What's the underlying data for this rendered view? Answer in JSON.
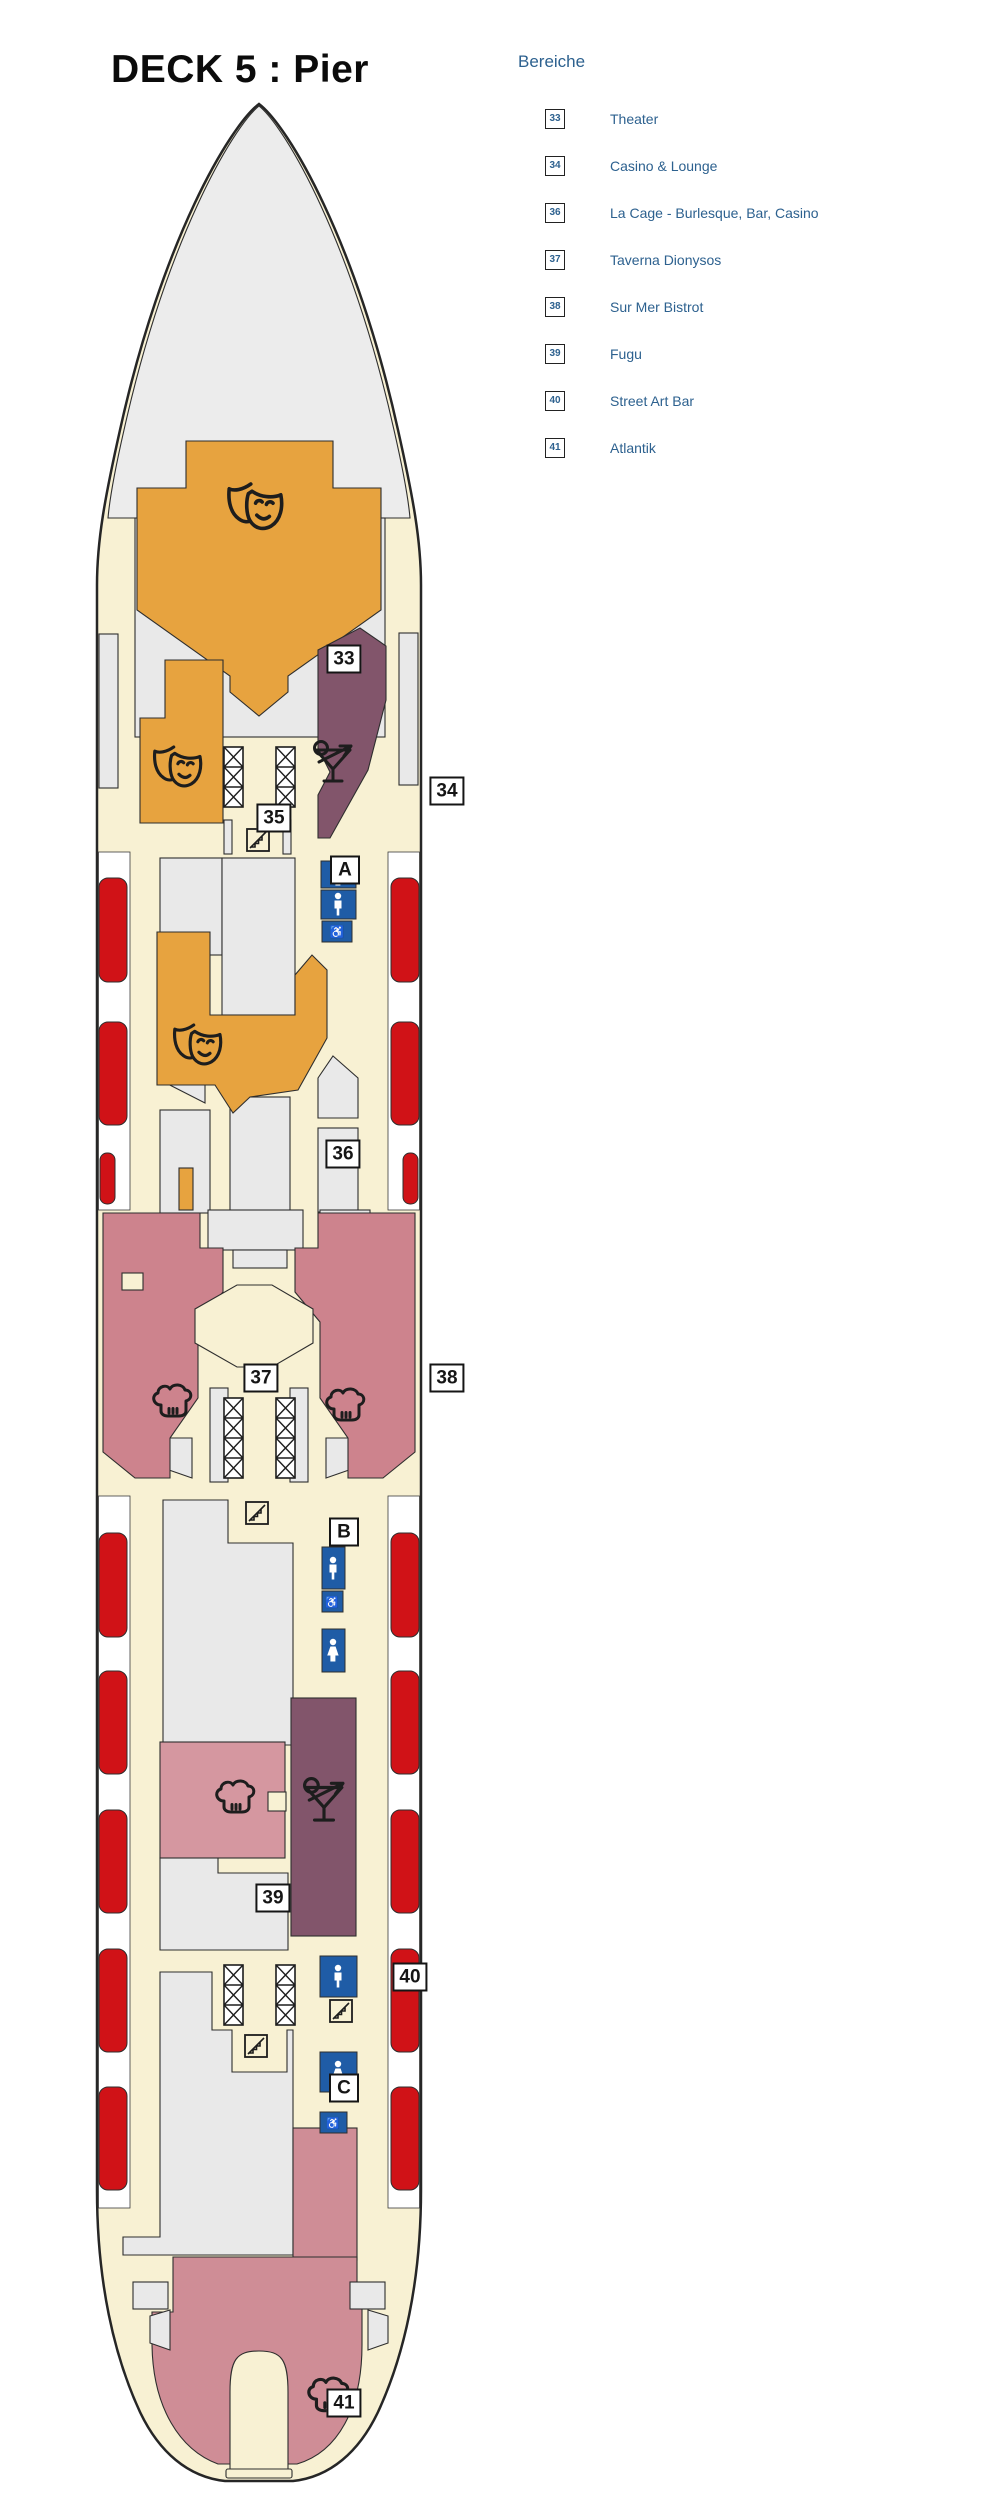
{
  "page": {
    "title": "DECK 5 : Pier"
  },
  "legend": {
    "title": "Bereiche",
    "items": [
      {
        "number": "33",
        "label": "Theater"
      },
      {
        "number": "34",
        "label": "Casino & Lounge"
      },
      {
        "number": "36",
        "label": "La Cage - Burlesque, Bar, Casino"
      },
      {
        "number": "37",
        "label": "Taverna Dionysos"
      },
      {
        "number": "38",
        "label": "Sur Mer Bistrot"
      },
      {
        "number": "39",
        "label": "Fugu"
      },
      {
        "number": "40",
        "label": "Street Art Bar"
      },
      {
        "number": "41",
        "label": "Atlantik"
      }
    ]
  },
  "deck_plan": {
    "labels": [
      {
        "id": "33",
        "text": "33"
      },
      {
        "id": "35",
        "text": "35"
      },
      {
        "id": "34",
        "text": "34"
      },
      {
        "id": "A",
        "text": "A"
      },
      {
        "id": "36",
        "text": "36"
      },
      {
        "id": "37",
        "text": "37"
      },
      {
        "id": "38",
        "text": "38"
      },
      {
        "id": "B",
        "text": "B"
      },
      {
        "id": "39",
        "text": "39"
      },
      {
        "id": "40",
        "text": "40"
      },
      {
        "id": "C",
        "text": "C"
      },
      {
        "id": "41",
        "text": "41"
      }
    ],
    "icons": {
      "theater": "comedy-masks-icon",
      "bar": "cocktail-glass-icon",
      "restaurant": "chef-hat-icon",
      "stairs": "crosshatch-stairs-icon",
      "escalator": "escalator-icon",
      "wc_male": "man-icon",
      "wc_female": "woman-icon",
      "wc_accessible": "wheelchair-icon"
    }
  },
  "colors": {
    "legendblue": "#2d618f",
    "cream": "#f8f1d3",
    "gray": "#e9e9e9",
    "bowgray": "#ececec",
    "orange": "#e7a33f",
    "mauve": "#82556b",
    "rose": "#cd838d",
    "roselight": "#d597a0",
    "rosestern": "#cf8d96",
    "red": "#d01217",
    "blue": "#1f5ca6",
    "ink": "#1d1d1d"
  }
}
